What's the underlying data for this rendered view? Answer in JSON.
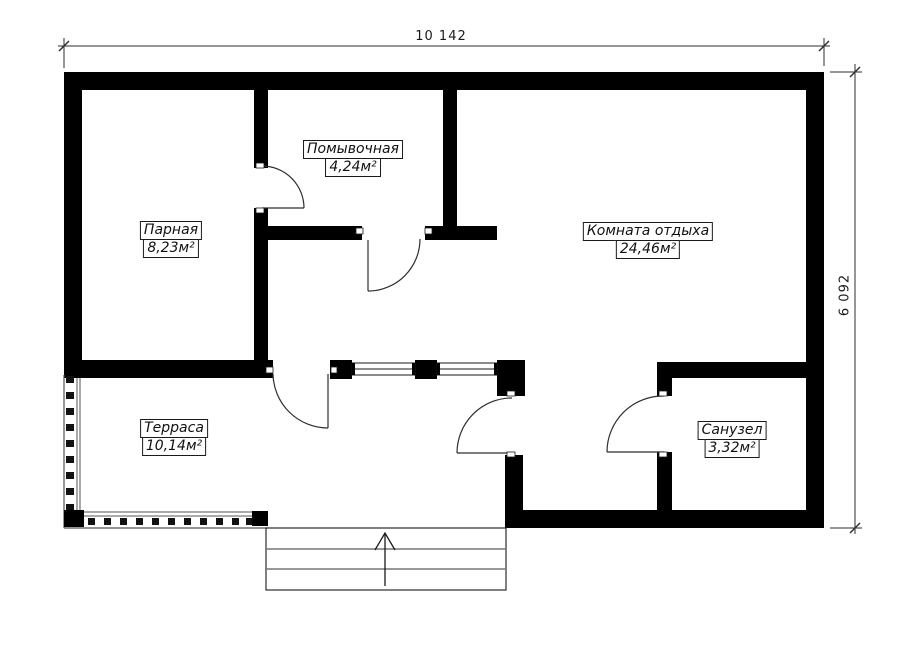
{
  "plan": {
    "rooms": [
      {
        "name": "Парная",
        "area": "8,23м²"
      },
      {
        "name": "Помывочная",
        "area": "4,24м²"
      },
      {
        "name": "Комната отдыха",
        "area": "24,46м²"
      },
      {
        "name": "Терраса",
        "area": "10,14м²"
      },
      {
        "name": "Санузел",
        "area": "3,32м²"
      }
    ],
    "dimensions": {
      "width": "10 142",
      "height": "6 092"
    },
    "colors": {
      "wall": "#000000",
      "line": "#2e2e2e",
      "background": "#ffffff"
    }
  }
}
